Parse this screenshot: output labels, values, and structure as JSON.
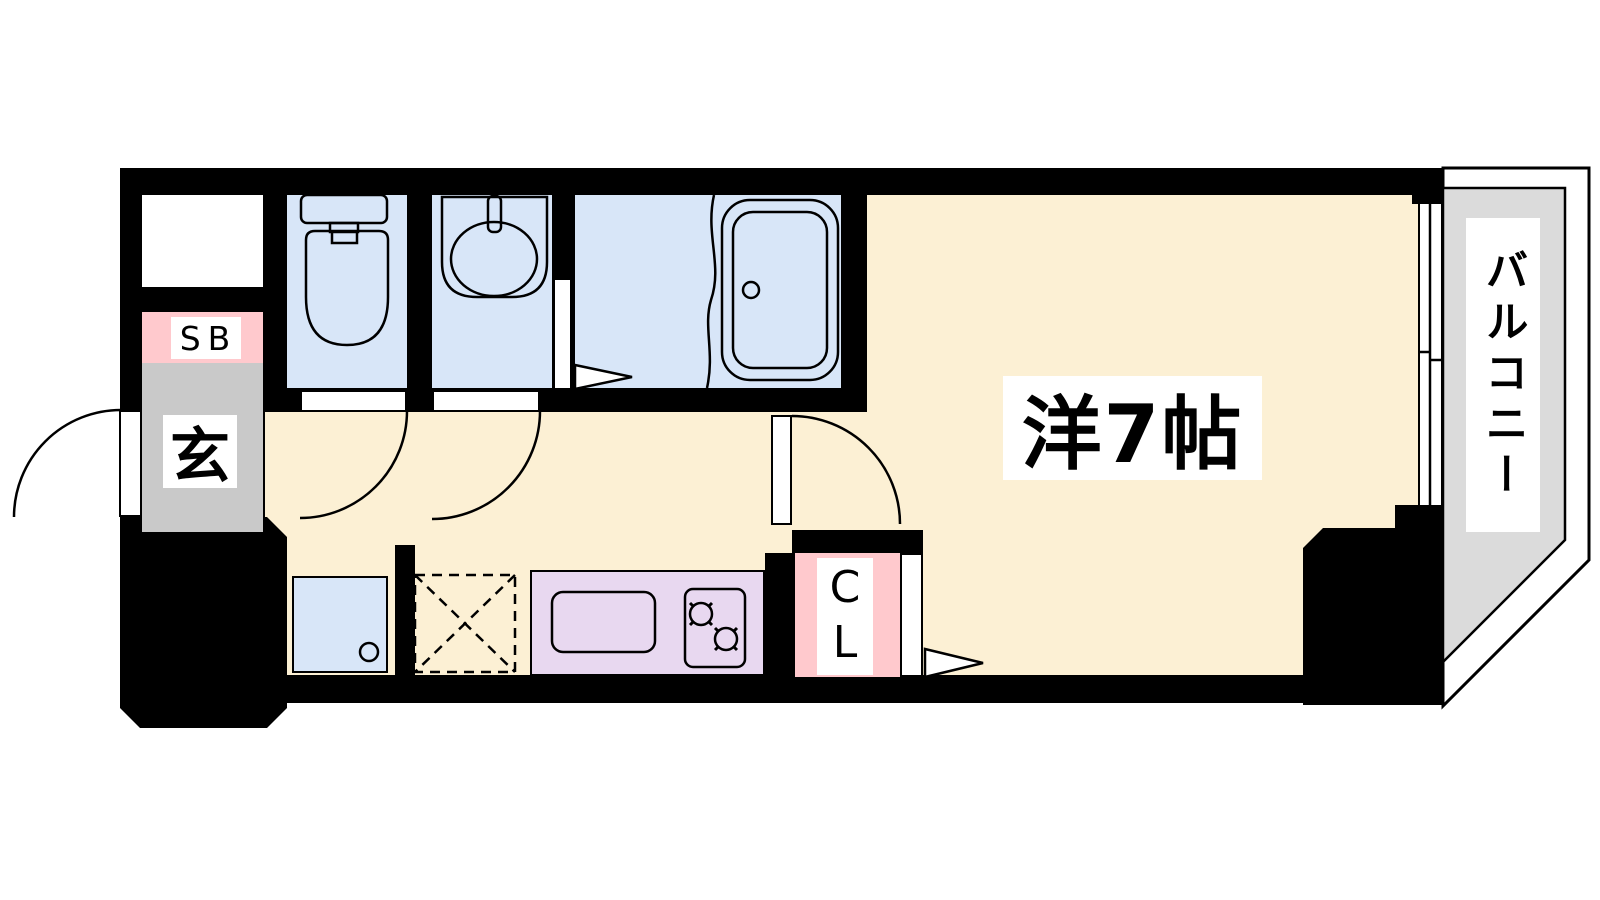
{
  "plan": {
    "type": "apartment-floor-plan",
    "rooms": {
      "main_room": {
        "label": "洋7帖",
        "floor_color": "#FCF0D4"
      },
      "balcony": {
        "label": "バルコニー",
        "floor_color": "#DBDBDB"
      },
      "entrance": {
        "label": "玄",
        "floor_color": "#C9C9C9"
      },
      "shoe_box": {
        "label": "SB",
        "accent_color": "#FFC9CD"
      },
      "closet": {
        "label": "CL",
        "accent_color": "#FFC9CD"
      },
      "toilet": {
        "floor_color": "#D8E6F8"
      },
      "washroom": {
        "floor_color": "#D8E6F8"
      },
      "bathroom": {
        "floor_color": "#D8E6F8"
      },
      "kitchen": {
        "counter_color": "#E8D8F0"
      },
      "laundry_pan": {
        "floor_color": "#D8E6F8"
      }
    },
    "wall_color": "#000000",
    "background_color": "#FFFFFF"
  }
}
